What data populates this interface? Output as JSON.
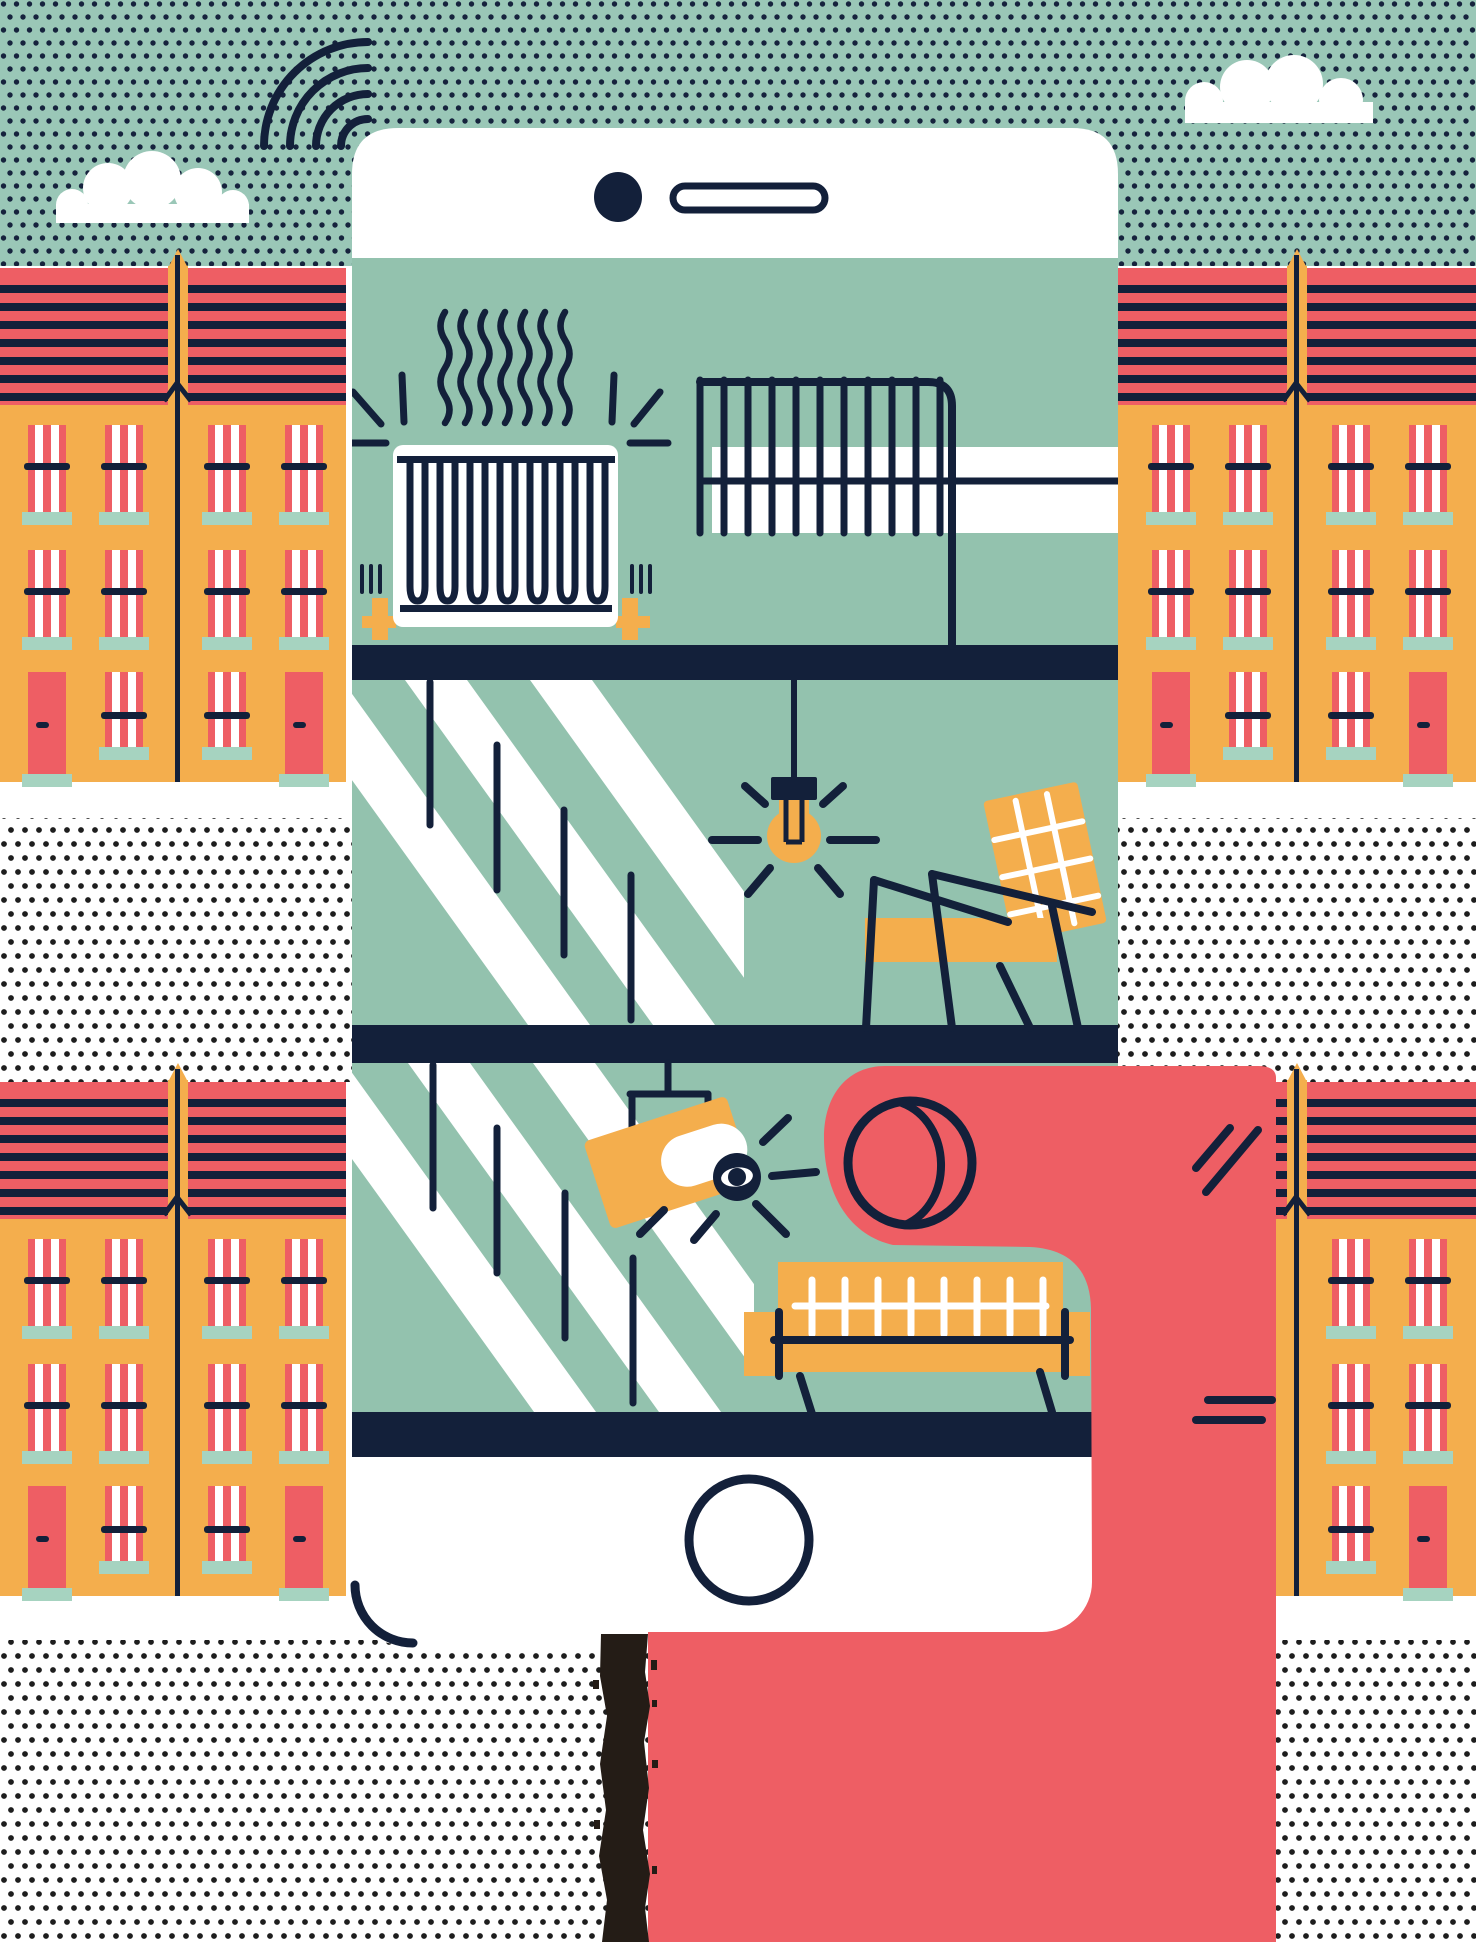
{
  "scene": {
    "title": "Editorial illustration: hand holding a smartphone showing a smart-home cross-section in front of terraced houses",
    "objects": [
      "halftone-sky",
      "wifi-signal",
      "clouds",
      "terraced-houses",
      "smartphone",
      "front-camera-dot",
      "speaker-grille",
      "home-button",
      "radiator-with-heat-waves",
      "drying-rack-with-towel",
      "staircase-window",
      "pendant-light-bulb",
      "armchair",
      "security-camera",
      "sofa",
      "hand-with-thumb",
      "arm",
      "charcoal-stripe"
    ]
  },
  "colors": {
    "background": "#ffffff",
    "sky": "#9ac7b7",
    "skyDot": "#16233d",
    "screen": "#93c2ae",
    "navy": "#13203a",
    "coral": "#ee5e64",
    "yellow": "#f4ae4d",
    "mint": "#a6d3c0",
    "white": "#ffffff",
    "paperDot": "#1e1e1e",
    "charcoal": "#241c16"
  }
}
